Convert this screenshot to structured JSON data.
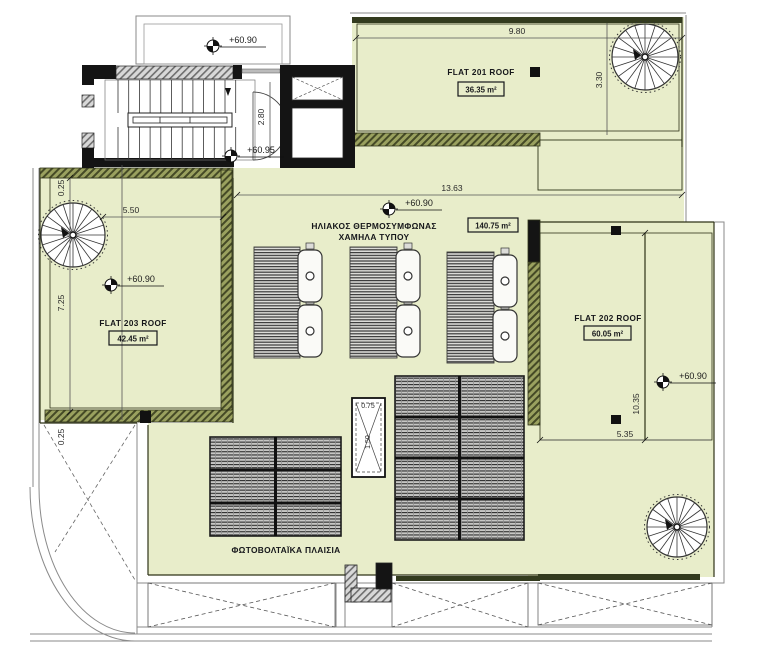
{
  "colors": {
    "roof_green": "#e8edca",
    "parapet_olive": "#9aa15f",
    "hatch_dark": "#454a26",
    "wall_black": "#141414",
    "line_dark": "#2e3318"
  },
  "flats": {
    "flat201": {
      "name": "FLAT 201 ROOF",
      "area": "36.35 m²"
    },
    "flat202": {
      "name": "FLAT 202 ROOF",
      "area": "60.05 m²"
    },
    "flat203": {
      "name": "FLAT 203 ROOF",
      "area": "42.45 m²"
    }
  },
  "annotations": {
    "central_area": "140.75 m²",
    "solar_line1": "ΗΛΙΑΚΟΣ ΘΕΡΜΟΣΥΜΦΩΝΑΣ",
    "solar_line2": "ΧΑΜΗΛΑ ΤΥΠΟΥ",
    "pv_label": "ΦΩΤΟΒΟΛΤΑΪΚΑ ΠΛΑΙΣΙΑ"
  },
  "elevations": {
    "landing": "+60.90",
    "stair": "+60.95",
    "central": "+60.90",
    "flat203": "+60.90",
    "flat202": "+60.90"
  },
  "dimensions": {
    "top_width": "9.80",
    "flat201_depth": "3.30",
    "central_width": "13.63",
    "flat203_top": "5.50",
    "flat203_offset": "0.25",
    "flat203_side": "7.25",
    "stair_opening": "2.80",
    "flat202_side": "10.35",
    "flat202_bottom": "5.35",
    "skylight_w": "0.75",
    "skylight_h": "1.50",
    "courtyard_offset": "0.25"
  }
}
